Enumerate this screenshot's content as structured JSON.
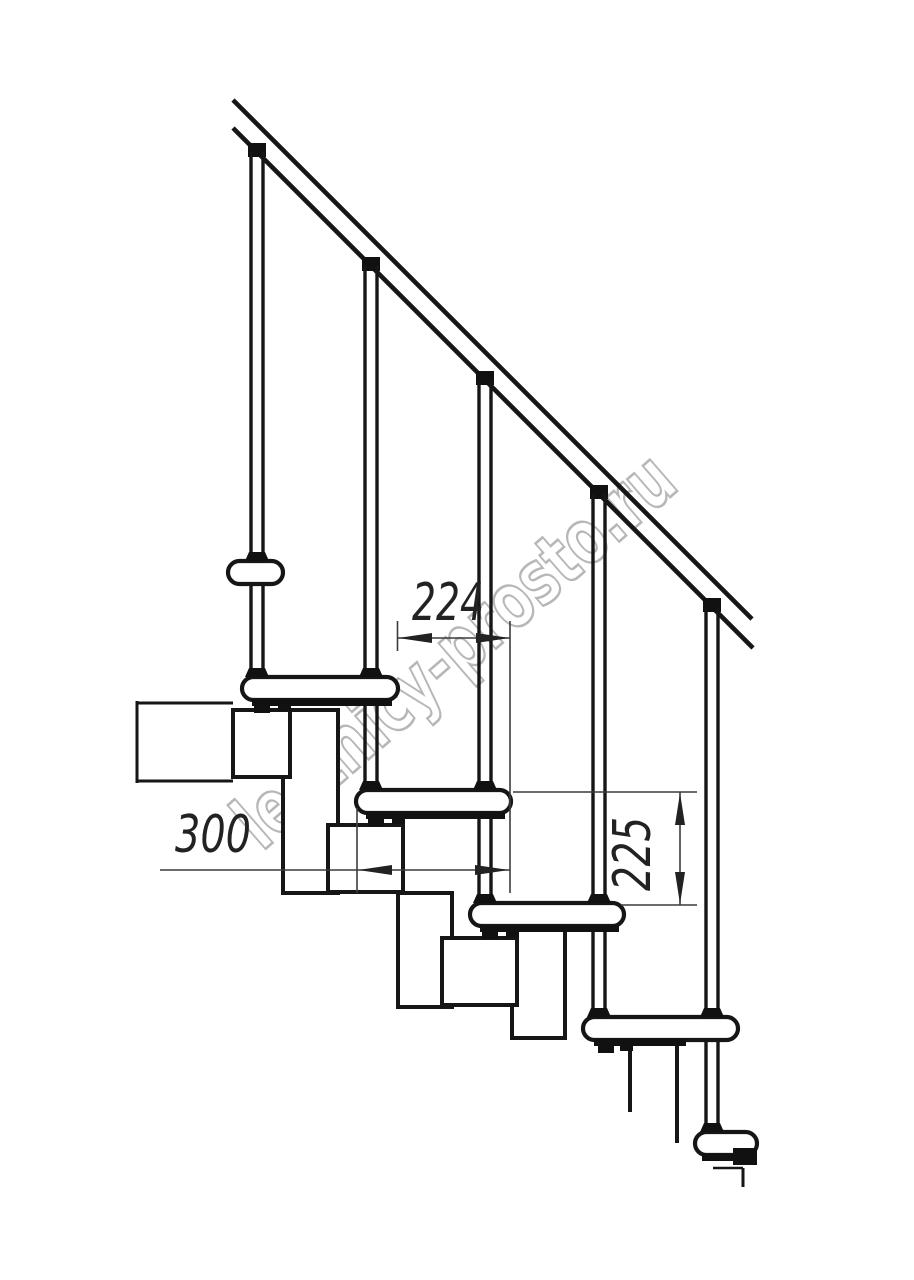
{
  "figure": {
    "type": "technical-drawing",
    "subject": "modular staircase side elevation",
    "treads_visible": 6,
    "balusters_visible": 5
  },
  "dimensions": {
    "going": {
      "value": "224",
      "orientation": "horizontal"
    },
    "tread_depth": {
      "value": "300",
      "orientation": "horizontal"
    },
    "rise": {
      "value": "225",
      "orientation": "vertical"
    }
  },
  "watermark": {
    "text": "lestnicy-prosto.ru"
  },
  "colors": {
    "line": "#161616",
    "dimension": "#3c3c3c",
    "dimension_text": "#222222",
    "watermark_outline": "#b0b0b0",
    "background": "#ffffff"
  }
}
